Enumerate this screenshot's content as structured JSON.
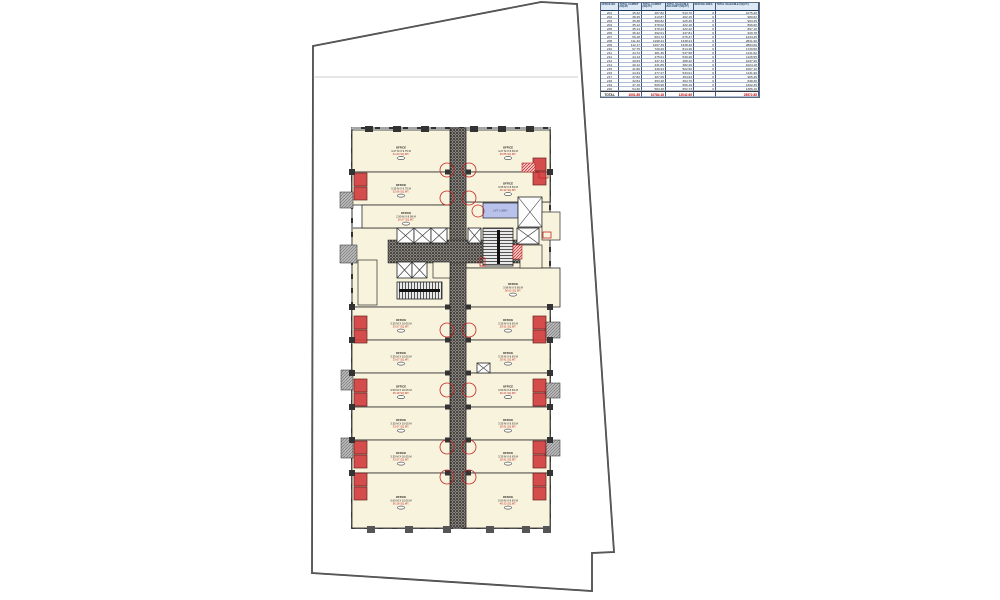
{
  "drawing": {
    "type_label": "TYPICAL OFFICE FLOOR PLAN",
    "lift_lobby_label": "LIFT LOBBY"
  },
  "colors": {
    "unit_fill": "#f8f3dd",
    "wall": "#1c1c1c",
    "corridor_dot": "#2b2b2b",
    "corridor_base": "#8f8a81",
    "accent_red": "#c42525",
    "lobby_blue": "#b9c2ea",
    "duct_gray": "#9a9a9a",
    "table_header_bg": "#dce9f5",
    "table_header_text": "#17375e",
    "table_total_text": "#c00000"
  },
  "units": [
    {
      "name": "OFFICE",
      "dims": "4.27 M X 9.75 M",
      "area": "41.63 SQ.MT."
    },
    {
      "name": "OFFICE",
      "dims": "3.35 M X 9.75 M",
      "area": "32.66 SQ.MT."
    },
    {
      "name": "OFFICE",
      "dims": "2.90 M X 8.99 M",
      "area": "26.07 SQ.MT."
    },
    {
      "name": "OFFICE",
      "dims": "3.35 M X 10.05 M",
      "area": "33.67 SQ.MT."
    },
    {
      "name": "OFFICE",
      "dims": "3.35 M X 10.05 M",
      "area": "33.67 SQ.MT."
    },
    {
      "name": "OFFICE",
      "dims": "3.50 M X 10.05 M",
      "area": "35.18 SQ.MT."
    },
    {
      "name": "OFFICE",
      "dims": "3.35 M X 10.05 M",
      "area": "33.67 SQ.MT."
    },
    {
      "name": "OFFICE",
      "dims": "3.35 M X 10.05 M",
      "area": "33.67 SQ.MT."
    },
    {
      "name": "OFFICE",
      "dims": "5.60 M X 10.05 M",
      "area": "56.28 SQ.MT."
    },
    {
      "name": "OFFICE",
      "dims": "4.27 M X 8.63 M",
      "area": "36.85 SQ.MT."
    },
    {
      "name": "OFFICE",
      "dims": "3.05 M X 8.63 M",
      "area": "26.32 SQ.MT."
    },
    {
      "name": "OFFICE",
      "dims": "3.96 M X 9.60 M",
      "area": "38.02 SQ.MT."
    },
    {
      "name": "OFFICE",
      "dims": "3.35 M X 8.63 M",
      "area": "28.91 SQ.MT."
    },
    {
      "name": "OFFICE",
      "dims": "3.35 M X 8.63 M",
      "area": "28.91 SQ.MT."
    },
    {
      "name": "OFFICE",
      "dims": "3.50 M X 8.63 M",
      "area": "30.21 SQ.MT."
    },
    {
      "name": "OFFICE",
      "dims": "3.35 M X 8.63 M",
      "area": "28.91 SQ.MT."
    },
    {
      "name": "OFFICE",
      "dims": "3.35 M X 8.63 M",
      "area": "28.91 SQ.MT."
    },
    {
      "name": "OFFICE",
      "dims": "5.60 M X 8.63 M",
      "area": "48.33 SQ.MT."
    }
  ],
  "table": {
    "headers": [
      "OFFICE NO.",
      "TOTAL CARPET (SQ.M)",
      "TOTAL CARPET (SQ.FT.)",
      "TOTAL SALEABLE BALCONY (SQ.FT.)",
      "REFUGE AREA",
      "TOTAL SALEABLE (SQ.FT.)"
    ],
    "rows": [
      [
        "201",
        "45.32",
        "487.82",
        "543.70",
        "0",
        "1075.40"
      ],
      [
        "202",
        "38.45",
        "413.87",
        "462.15",
        "0",
        "980.62"
      ],
      [
        "203",
        "35.38",
        "380.82",
        "425.30",
        "0",
        "903.25"
      ],
      [
        "204",
        "35.12",
        "378.02",
        "422.18",
        "0",
        "896.60"
      ],
      [
        "205",
        "35.14",
        "378.23",
        "422.42",
        "0",
        "897.10"
      ],
      [
        "206",
        "36.42",
        "392.01",
        "437.81",
        "0",
        "929.78"
      ],
      [
        "207",
        "56.18",
        "604.72",
        "675.37",
        "0",
        "1434.25"
      ],
      [
        "208",
        "111.32",
        "1198.24",
        "1338.24",
        "0",
        "2841.90"
      ],
      [
        "209",
        "112.17",
        "1207.39",
        "1348.46",
        "0",
        "2863.60"
      ],
      [
        "210",
        "67.75",
        "729.26",
        "814.46",
        "0",
        "1729.50"
      ],
      [
        "211",
        "44.72",
        "481.36",
        "537.58",
        "0",
        "1141.62"
      ],
      [
        "212",
        "44.13",
        "475.01",
        "530.49",
        "0",
        "1126.55"
      ],
      [
        "213",
        "40.63",
        "437.34",
        "488.42",
        "0",
        "1037.20"
      ],
      [
        "214",
        "40.12",
        "431.85",
        "482.29",
        "0",
        "1024.18"
      ],
      [
        "215",
        "41.80",
        "449.94",
        "502.50",
        "0",
        "1067.10"
      ],
      [
        "216",
        "44.34",
        "477.27",
        "533.01",
        "0",
        "1131.90"
      ],
      [
        "217",
        "37.82",
        "407.09",
        "454.63",
        "0",
        "965.45"
      ],
      [
        "218",
        "32.84",
        "353.48",
        "394.76",
        "0",
        "838.30"
      ],
      [
        "219",
        "47.10",
        "506.98",
        "566.19",
        "0",
        "1202.35"
      ],
      [
        "220",
        "54.30",
        "584.48",
        "652.73",
        "0",
        "1386.10"
      ]
    ],
    "total": [
      "TOTAL",
      "1001.85",
      "10784.16",
      "12042.69",
      "",
      "25572.85"
    ]
  }
}
